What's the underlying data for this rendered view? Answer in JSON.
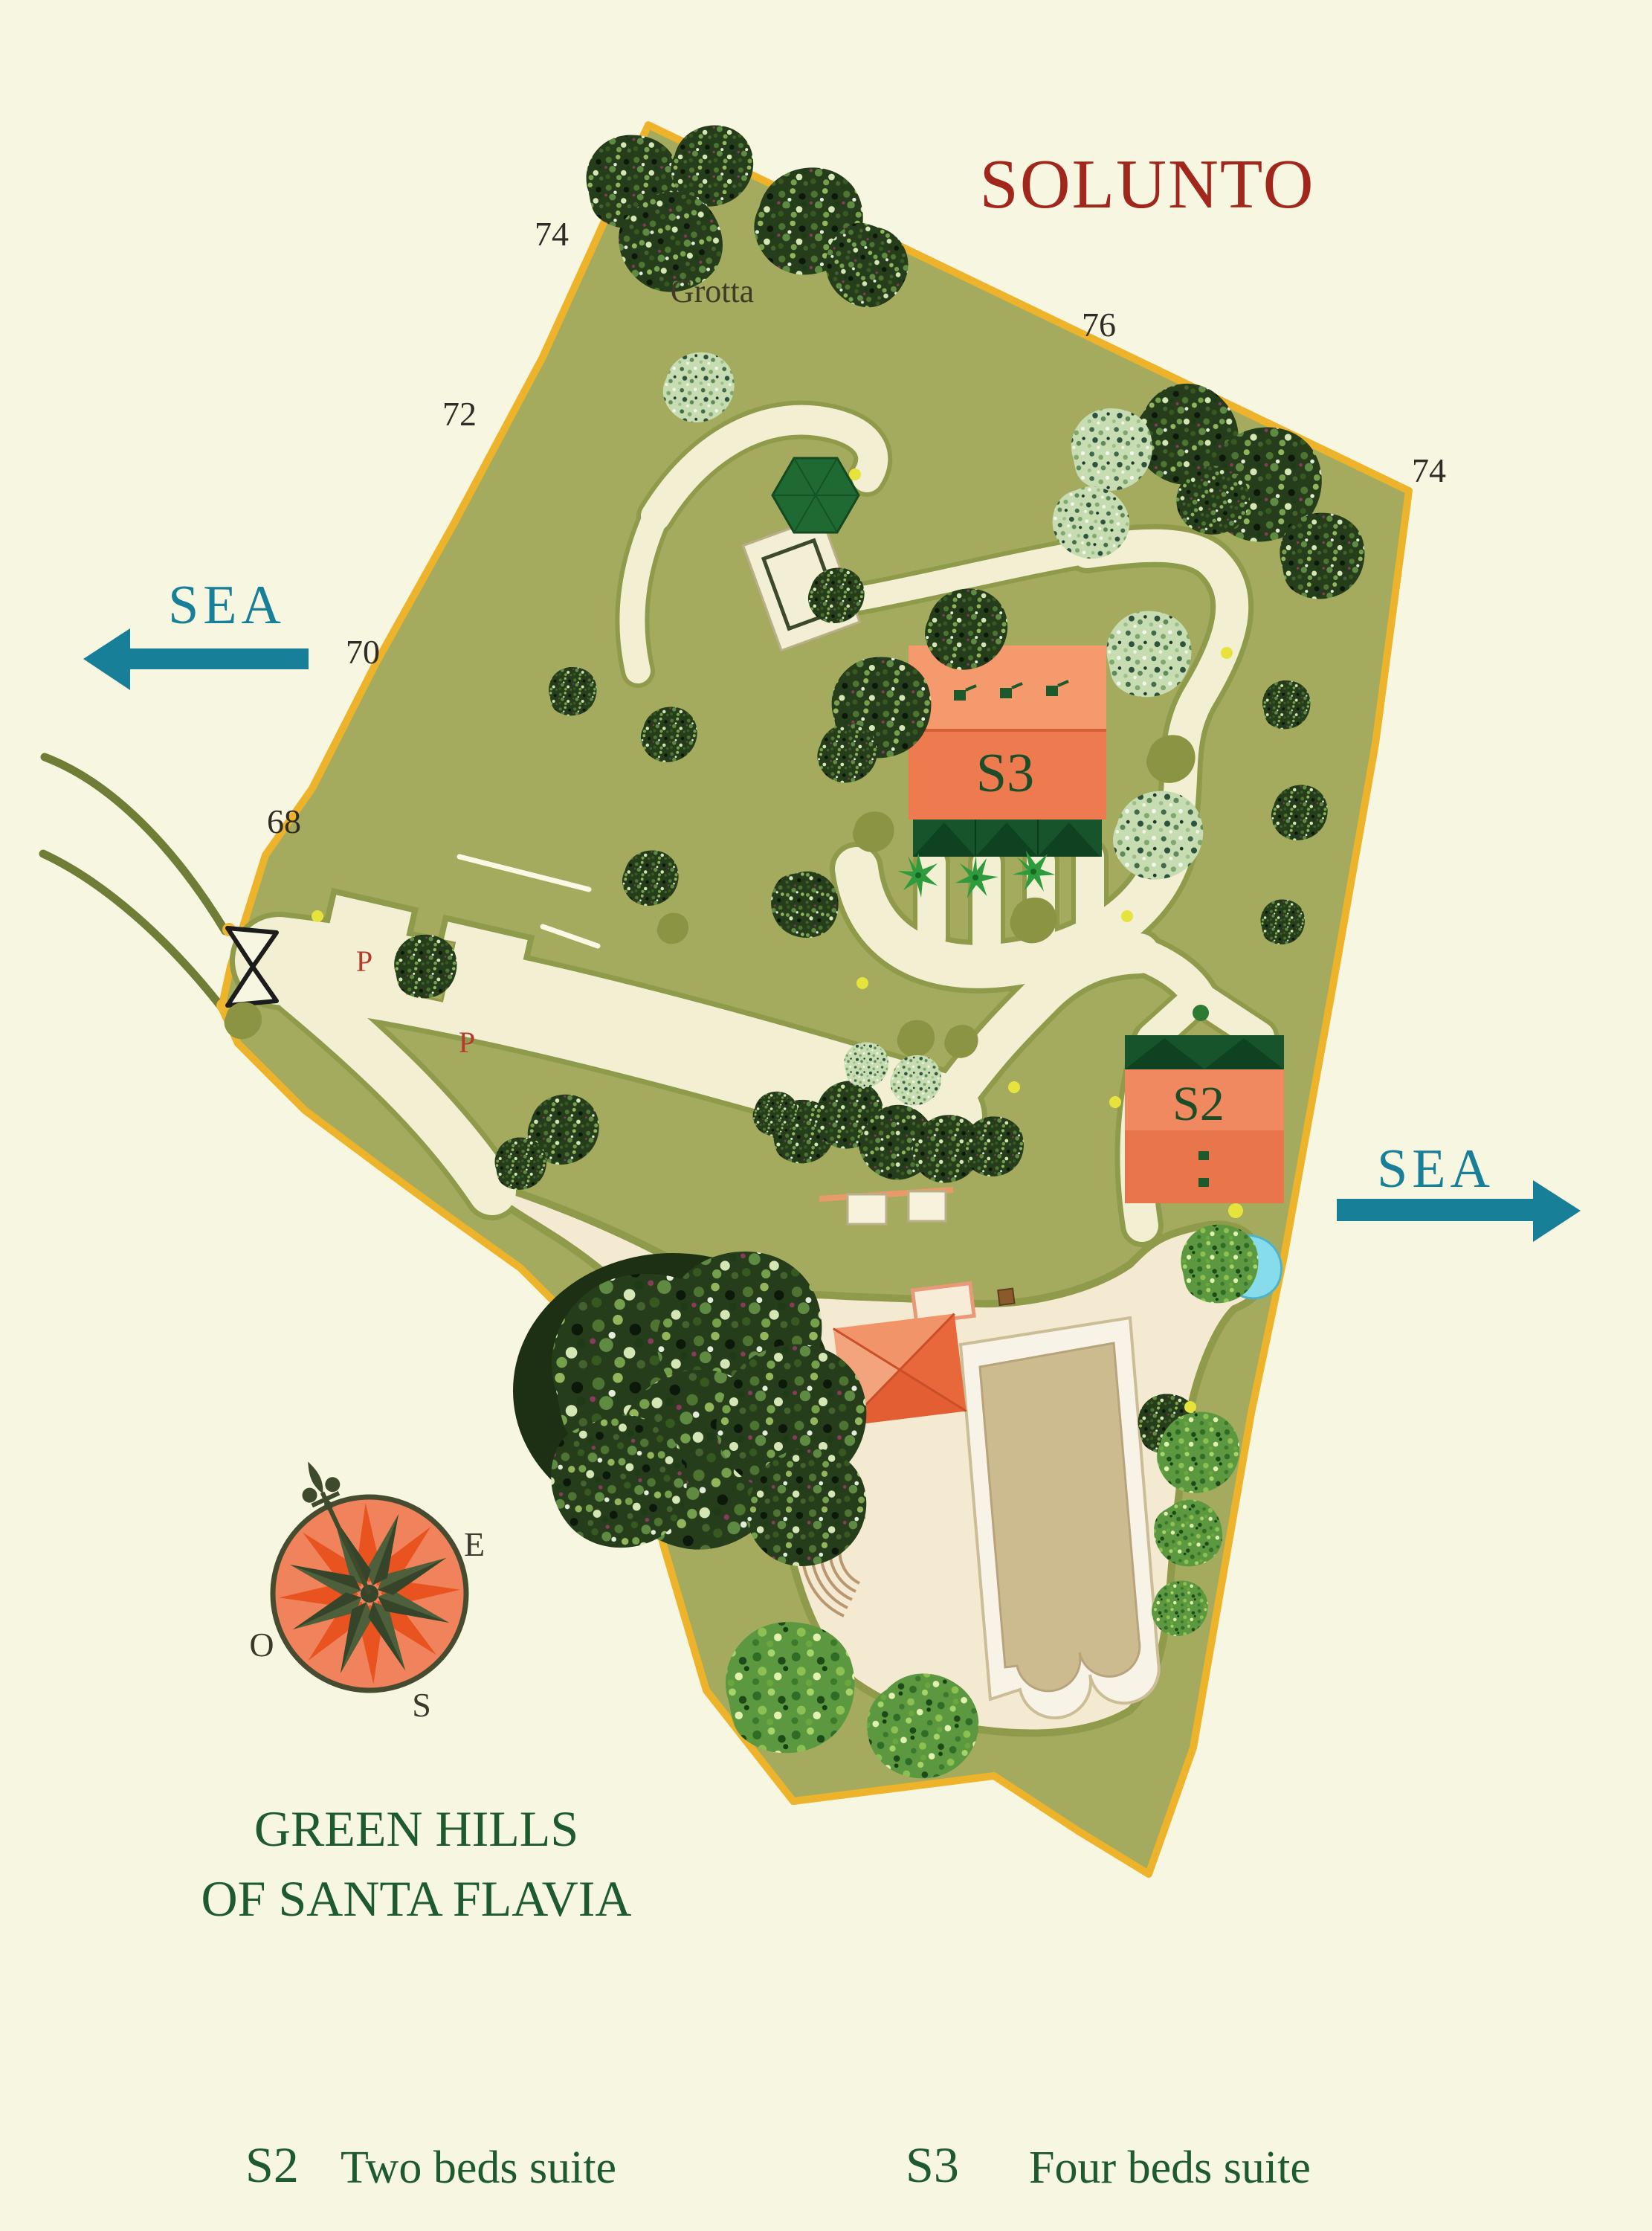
{
  "title": "SOLUNTO",
  "map": {
    "area_label": "Grotta",
    "parking": {
      "p1": "P",
      "p2": "P"
    },
    "buildings": {
      "s3": "S3",
      "s2": "S2"
    },
    "boundary_numbers": {
      "top_left": "74",
      "left_upper": "72",
      "left_mid": "70",
      "left_lower": "68",
      "top_right": "76",
      "right": "74"
    },
    "sea": {
      "left": "SEA",
      "right": "SEA"
    }
  },
  "compass": {
    "east": "E",
    "west": "O",
    "south": "S"
  },
  "footer": {
    "name_line1": "GREEN HILLS",
    "name_line2": "OF SANTA FLAVIA"
  },
  "legend": {
    "items": [
      {
        "code": "S2",
        "label": "Two beds suite"
      },
      {
        "code": "S3",
        "label": "Four beds suite"
      }
    ]
  },
  "colors": {
    "background": "#f7f6e1",
    "land": "#a5ab5e",
    "boundary": "#edb32a",
    "road": "#f2efd2",
    "sea_teal": "#187f99",
    "title_red": "#a1271c",
    "building_salmon": "#ef8558",
    "awning_green": "#17542b",
    "label_green": "#1d5a2e",
    "parking_red": "#b5392c",
    "pond_cyan": "#86dcea"
  }
}
